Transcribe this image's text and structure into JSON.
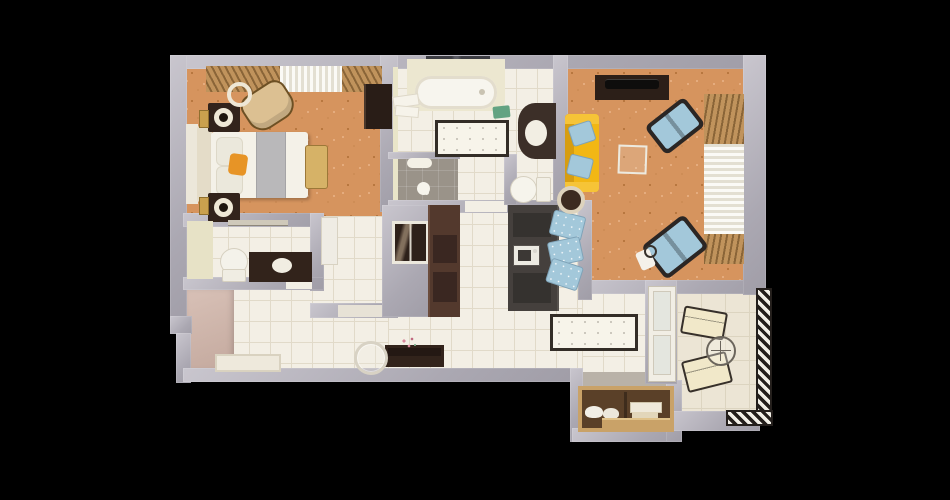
{
  "scene": {
    "description": "3D top-down floor plan render of a one-bedroom apartment with balcony on a black background",
    "rooms": [
      {
        "id": "bedroom",
        "label": "Bedroom",
        "floor": "orange patterned carpet"
      },
      {
        "id": "bathroom",
        "label": "Bathroom",
        "floor": "white ceramic tile"
      },
      {
        "id": "wc",
        "label": "WC / powder room",
        "floor": "white ceramic tile"
      },
      {
        "id": "living-room",
        "label": "Living room",
        "floor": "orange patterned carpet"
      },
      {
        "id": "kitchen-dining",
        "label": "Kitchen / dining",
        "floor": "white ceramic tile"
      },
      {
        "id": "hallway",
        "label": "Hallway / entry",
        "floor": "white ceramic tile"
      },
      {
        "id": "closet",
        "label": "Built-in wardrobe closet",
        "floor": "wood"
      },
      {
        "id": "balcony",
        "label": "Balcony with hatched railing",
        "floor": "cream tile"
      }
    ],
    "furniture": {
      "bedroom": [
        "double bed with grey runner and orange throw pillow",
        "two dark nightstands with round lamps",
        "two gold wall sconces",
        "tan armchair",
        "floor lamp",
        "foot bench",
        "dark wardrobe",
        "window with wooden blinds and white curtain"
      ],
      "bathroom": [
        "bathtub on cream deck under dark window",
        "towel stack",
        "green soap tray",
        "dark rounded vanity with basin",
        "toilet in nook",
        "walk-in shower with mat and handset",
        "dotted bath rug"
      ],
      "wc": [
        "toilet with tank",
        "dark vanity with basin",
        "towel rail",
        "white door panel"
      ],
      "living-room": [
        "dark TV console with TV",
        "yellow sofa with two blue cushions",
        "round side rug",
        "glass coffee table",
        "two blue armchairs with dark frames",
        "headphone stand",
        "window with wooden blinds and white curtain"
      ],
      "kitchen-dining": [
        "brown kitchen counter with appliance panels",
        "charcoal island with sink",
        "three upholstered bar stools",
        "quilted kitchen rug",
        "framed wall mirror on utility wall"
      ],
      "hallway": [
        "dark console table with pink flowers",
        "round leaning mirror",
        "doormat",
        "entry niche"
      ],
      "closet": [
        "wardrobe with white pillows, folded linens and wooden shelf"
      ],
      "balcony": [
        "two cream lounge chairs",
        "round wireframe table",
        "hatched safety railing"
      ]
    },
    "colors": {
      "bg": "#000000",
      "wall-a": "#c9c6ce",
      "wall-b": "#aba8b2",
      "tile": "#f3efe5",
      "tile-line": "#e1dac9",
      "orange": "#d6945e",
      "orange-dark": "#b8773f",
      "orange-light": "#eab488",
      "shower": "#9a9389",
      "balcony-tile": "#ece5d5",
      "balcony-line": "#dcd4c0",
      "wood-blind": "#c0935c",
      "wood-blind-dark": "#8a6538",
      "curtain-light": "#fbfaf6",
      "curtain-shade": "#e3dfd2",
      "dark-furn": "#32231b",
      "island": "#45403d",
      "counter": "#53392d",
      "yellow": "#f2b714",
      "yellow-dark": "#d79d10",
      "blue": "#a3c8da",
      "blue-border": "#7fa3b8",
      "frame-dark": "#2b2624",
      "white-furn": "#f4f1e8",
      "cream": "#ece7d0",
      "rug-border": "#332d27",
      "closet-wood": "#c9a268",
      "closet-interior": "#5a4028",
      "niche-a": "#d9c2b8",
      "niche-b": "#c3a89d",
      "green": "#63a382",
      "pink": "#d9879b",
      "lamp-cream": "#efe8d6",
      "rail-dark": "#241f1c"
    }
  }
}
